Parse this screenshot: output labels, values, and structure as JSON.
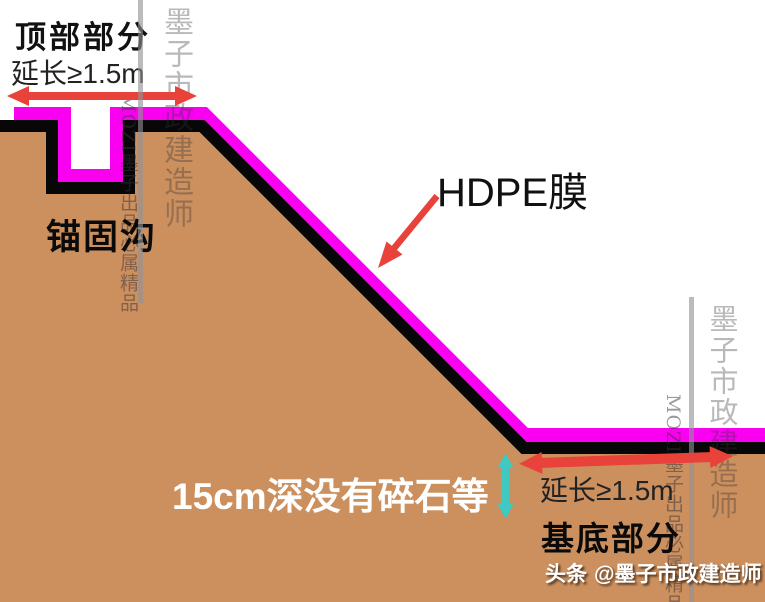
{
  "colors": {
    "ground": "#CC905E",
    "membrane": "#FA00F0",
    "outline": "#070707",
    "arrow_red": "#E8423B",
    "arrow_cyan": "#3FC9C3",
    "label_black": "#1A1A1A",
    "label_white": "#FFFFFF"
  },
  "top_section": {
    "title": "顶部部分",
    "extend_note": "延长≥1.5m"
  },
  "anchor_trench": {
    "label": "锚固沟"
  },
  "membrane": {
    "label": "HDPE膜"
  },
  "base_section": {
    "depth_note": "15cm深没有碎石等",
    "extend_note": "延长≥1.5m",
    "title": "基底部分"
  },
  "credit": {
    "prefix": "头条",
    "handle": "@墨子市政建造师"
  },
  "watermark": {
    "title": "墨子市政建造师",
    "tagline": "MOZI墨子出品必属精品"
  }
}
